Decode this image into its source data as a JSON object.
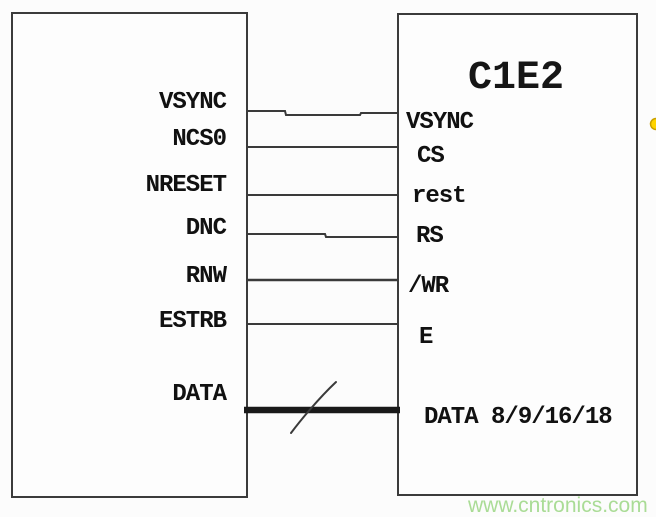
{
  "diagram": {
    "left_block": {
      "pins": [
        {
          "label": "VSYNC"
        },
        {
          "label": "NCS0"
        },
        {
          "label": "NRESET"
        },
        {
          "label": "DNC"
        },
        {
          "label": "RNW"
        },
        {
          "label": "ESTRB"
        },
        {
          "label": "DATA"
        }
      ]
    },
    "right_block": {
      "title": "C1E2",
      "pins": [
        {
          "label": "VSYNC"
        },
        {
          "label": "CS"
        },
        {
          "label": "rest"
        },
        {
          "label": "RS"
        },
        {
          "label": "/WR"
        },
        {
          "label": "E"
        },
        {
          "label": "DATA 8/9/16/18"
        }
      ]
    },
    "watermark": "www.cntronics.com",
    "colors": {
      "wire": "#3a3a3a",
      "box_border": "#3b3b3b",
      "background": "#fcfcfc",
      "watermark_green": "#aadc96",
      "marker_yellow": "#ffd400",
      "marker_yellow_ring": "#c9a000"
    }
  }
}
